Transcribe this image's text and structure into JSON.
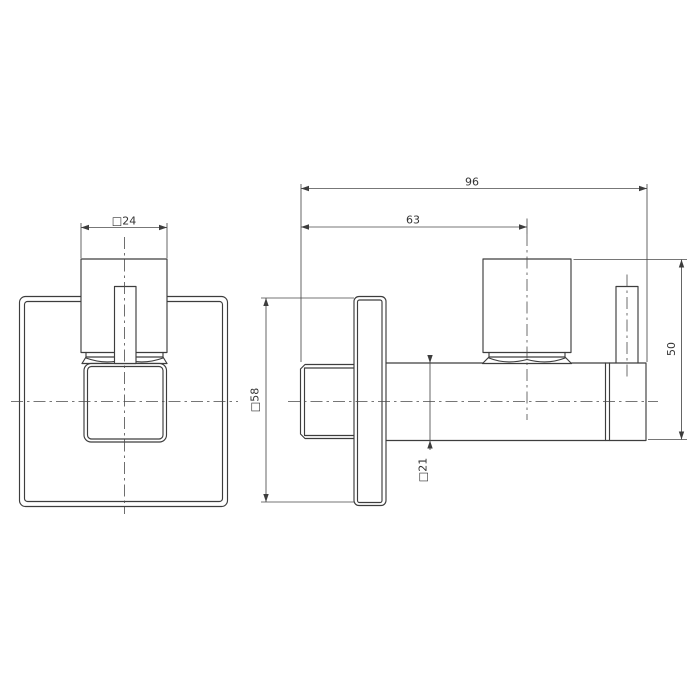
{
  "drawing": {
    "type": "technical-orthographic-drawing",
    "subject": "square wall-mounted angle valve, front and side elevation views",
    "background_color": "#ffffff",
    "line_color": "#3d3d3d",
    "dimension_line_color": "#4a4a4a",
    "text_color": "#333333",
    "dimensions": {
      "handle_width": "□24",
      "plate_size": "□58",
      "overall_length": "96",
      "handle_center_offset": "63",
      "overall_height": "50",
      "body_square": "□21"
    }
  }
}
